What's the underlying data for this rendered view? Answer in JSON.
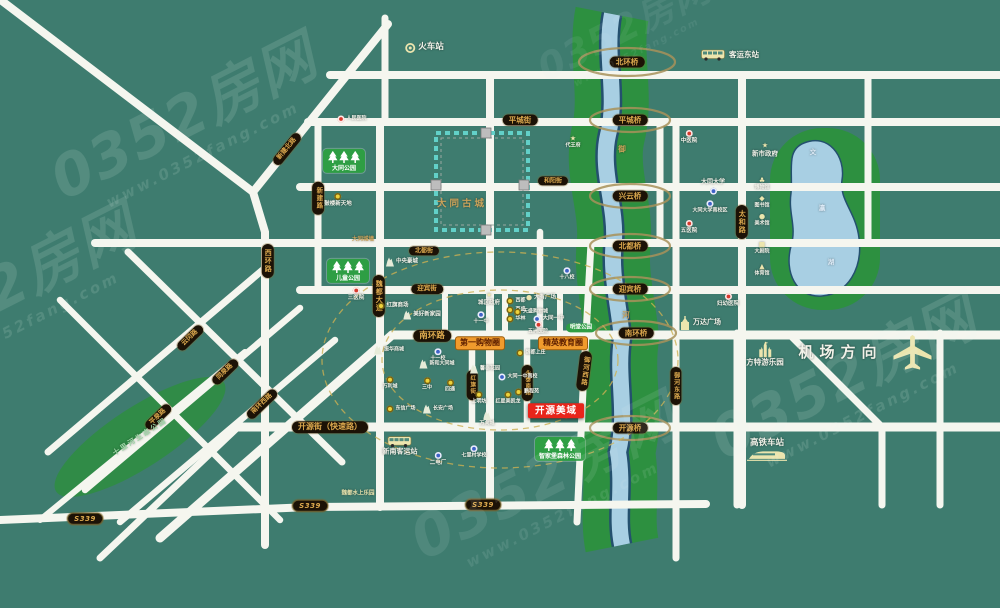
{
  "watermarks": {
    "brand": "0352房网",
    "site": "www.0352fang.com"
  },
  "map": {
    "labels": [
      {
        "n": "bridge-beihuanqiao",
        "t": "pill",
        "x": 627,
        "y": 62,
        "fs": 7.5,
        "text": "北环桥"
      },
      {
        "n": "bridge-pingchengqiao",
        "t": "pill",
        "x": 630,
        "y": 120,
        "fs": 7.5,
        "text": "平城桥"
      },
      {
        "n": "bridge-xingyunqiao",
        "t": "pill",
        "x": 630,
        "y": 196,
        "fs": 7.5,
        "text": "兴云桥"
      },
      {
        "n": "bridge-beiduqiao",
        "t": "pill",
        "x": 630,
        "y": 246,
        "fs": 7.5,
        "text": "北都桥"
      },
      {
        "n": "bridge-yingbinqiao",
        "t": "pill",
        "x": 630,
        "y": 289,
        "fs": 7.5,
        "text": "迎宾桥"
      },
      {
        "n": "bridge-nanhuanqiao",
        "t": "pill",
        "x": 636,
        "y": 333,
        "fs": 7.5,
        "text": "南环桥"
      },
      {
        "n": "bridge-kaiyuanqiao",
        "t": "pill",
        "x": 630,
        "y": 428,
        "fs": 7.5,
        "text": "开源桥"
      },
      {
        "n": "road-pingchengjie",
        "t": "pill",
        "x": 520,
        "y": 120,
        "fs": 7.5,
        "text": "平城街"
      },
      {
        "n": "road-heyangjie",
        "t": "pill",
        "x": 553,
        "y": 181,
        "fs": 6,
        "text": "和阳街"
      },
      {
        "n": "road-beidujie",
        "t": "pill",
        "x": 424,
        "y": 251,
        "fs": 6,
        "text": "北都街"
      },
      {
        "n": "road-yingbinjie",
        "t": "pill",
        "x": 427,
        "y": 289,
        "fs": 6.5,
        "text": "迎宾街"
      },
      {
        "n": "road-nanhuanlu",
        "t": "pill",
        "x": 432,
        "y": 336,
        "fs": 8.5,
        "text": "南环路"
      },
      {
        "n": "road-kaiyuanjie",
        "t": "pill",
        "x": 330,
        "y": 427,
        "fs": 8,
        "text": "开源街（快速路）"
      },
      {
        "n": "road-weidudadao",
        "t": "pill",
        "v": 1,
        "x": 379,
        "y": 296,
        "fs": 7,
        "text": "魏都大道"
      },
      {
        "n": "road-xinjianlu",
        "t": "pill",
        "v": 1,
        "x": 318,
        "y": 198,
        "fs": 6.5,
        "text": "新建路"
      },
      {
        "n": "road-xinjianbeilu",
        "t": "pill",
        "x": 287,
        "y": 149,
        "r": -51,
        "fs": 6.5,
        "text": "新建北路"
      },
      {
        "n": "road-xihuanlu",
        "t": "pill",
        "v": 1,
        "x": 268,
        "y": 261,
        "fs": 7,
        "text": "西环路"
      },
      {
        "n": "road-taihelu",
        "t": "pill",
        "v": 1,
        "x": 742,
        "y": 222,
        "fs": 7,
        "text": "太和路"
      },
      {
        "n": "road-yuhexilu",
        "t": "pill",
        "v": 1,
        "x": 584,
        "y": 371,
        "r": 7,
        "fs": 6.5,
        "text": "御河西路"
      },
      {
        "n": "road-yuhedonglu",
        "t": "pill",
        "v": 1,
        "x": 676,
        "y": 386,
        "fs": 6,
        "text": "御河东路"
      },
      {
        "n": "road-hongqijie",
        "t": "pill",
        "v": 1,
        "x": 472,
        "y": 385,
        "fs": 5.5,
        "text": "红旗街"
      },
      {
        "n": "road-yongtainanlu",
        "t": "pill",
        "v": 1,
        "x": 527,
        "y": 383,
        "fs": 5.5,
        "text": "永泰南路"
      },
      {
        "n": "road-yunganglu",
        "t": "pill",
        "x": 190,
        "y": 338,
        "r": -44,
        "fs": 6.5,
        "text": "云冈路"
      },
      {
        "n": "road-tongquanlu",
        "t": "pill",
        "x": 225,
        "y": 372,
        "r": -44,
        "fs": 6.5,
        "text": "同泉路"
      },
      {
        "n": "road-nanhuanxilu",
        "t": "pill",
        "x": 262,
        "y": 404,
        "r": -44,
        "fs": 6.5,
        "text": "南环西路"
      },
      {
        "n": "road-pingquanlu",
        "t": "pill",
        "x": 158,
        "y": 417,
        "r": -44,
        "fs": 6.5,
        "text": "平泉路"
      },
      {
        "n": "shield-s339-west",
        "t": "shield",
        "x": 85,
        "y": 519,
        "fs": 7,
        "text": "S339"
      },
      {
        "n": "shield-s339-mid",
        "t": "shield",
        "x": 310,
        "y": 506,
        "fs": 7,
        "text": "S339"
      },
      {
        "n": "shield-s339-east",
        "t": "shield",
        "x": 483,
        "y": 505,
        "fs": 7,
        "text": "S339"
      },
      {
        "n": "tag-shopping-circle",
        "t": "tag",
        "x": 480,
        "y": 343,
        "fs": 8,
        "text": "第一购物圈"
      },
      {
        "n": "tag-education-circle",
        "t": "tag",
        "x": 563,
        "y": 343,
        "fs": 8,
        "text": "精英教育圈"
      },
      {
        "n": "project-kaiyuanmeiyu",
        "t": "proj",
        "x": 556,
        "y": 411,
        "fs": 9.5,
        "text": "开源美域"
      },
      {
        "n": "park-datong",
        "t": "sign",
        "x": 344,
        "y": 161,
        "text": "大同公园"
      },
      {
        "n": "park-ertong",
        "t": "sign",
        "x": 348,
        "y": 271,
        "text": "儿童公园"
      },
      {
        "n": "park-zhijiabao",
        "t": "sign",
        "x": 560,
        "y": 449,
        "text": "智家堡森林公园"
      },
      {
        "n": "park-mingtang",
        "t": "ptag",
        "x": 581,
        "y": 328,
        "fs": 5.5,
        "text": "明堂公园"
      },
      {
        "n": "park-shilihe",
        "t": "txt",
        "x": 140,
        "y": 437,
        "c": "gl",
        "fs": 7,
        "r": -33,
        "ls": 2,
        "text": "十里河生态公园"
      },
      {
        "n": "ancient-city-label",
        "t": "txt",
        "x": 462,
        "y": 204,
        "c": "tan",
        "fs": 9.5,
        "ls": 3,
        "text": "大同古城"
      },
      {
        "n": "city-wall-label",
        "t": "txt",
        "x": 363,
        "y": 240,
        "c": "tan",
        "fs": 5.5,
        "text": "大同城墙"
      },
      {
        "n": "river-char-yu",
        "t": "txt",
        "x": 622,
        "y": 149,
        "c": "tan",
        "fs": 7.5,
        "text": "御"
      },
      {
        "n": "river-char-he",
        "t": "txt",
        "x": 626,
        "y": 315,
        "c": "tan",
        "fs": 7.5,
        "text": "河"
      },
      {
        "n": "lake-char-wen",
        "t": "txt",
        "x": 813,
        "y": 153,
        "c": "lake",
        "fs": 6.5,
        "text": "文"
      },
      {
        "n": "lake-char-ying",
        "t": "txt",
        "x": 822,
        "y": 209,
        "c": "lake",
        "fs": 6.5,
        "text": "瀛"
      },
      {
        "n": "lake-char-hu",
        "t": "txt",
        "x": 831,
        "y": 263,
        "c": "lake",
        "fs": 6.5,
        "text": "湖"
      },
      {
        "n": "train-station",
        "t": "poi",
        "ic": "svg:ring",
        "tp": "r",
        "x": 424,
        "y": 48,
        "c": "w",
        "fs": 8.5,
        "text": "火车站"
      },
      {
        "n": "east-bus-station",
        "t": "poi",
        "ic": "svg:bus",
        "tp": "r",
        "x": 730,
        "y": 55,
        "c": "w",
        "fs": 7.5,
        "text": "客运东站"
      },
      {
        "n": "south-bus-station",
        "t": "poi",
        "ic": "svg:bus",
        "tp": "b",
        "x": 400,
        "y": 446,
        "c": "cream",
        "fs": 7,
        "text": "新南客运站"
      },
      {
        "n": "airport-direction",
        "t": "poi",
        "ic": "svg:plane",
        "tp": "l",
        "x": 866,
        "y": 352,
        "c": "cream",
        "fs": 15,
        "ls": 6,
        "text": "机场方向"
      },
      {
        "n": "hsr-station",
        "t": "poi",
        "ic": "svg:hsr",
        "tp": "a",
        "x": 767,
        "y": 451,
        "c": "cream",
        "fs": 8.5,
        "text": "高铁车站"
      },
      {
        "n": "fantawild-park",
        "t": "poi",
        "ic": "svg:castle",
        "tp": "b",
        "x": 765,
        "y": 354,
        "c": "cream",
        "fs": 7.5,
        "text": "方特游乐园"
      },
      {
        "n": "wanda-plaza",
        "t": "poi",
        "ic": "svg:tower",
        "tp": "r",
        "x": 700,
        "y": 323,
        "c": "w",
        "fs": 7,
        "text": "万达广场"
      },
      {
        "n": "poi-renmin-hospital",
        "t": "poi",
        "ic": "red",
        "tp": "r",
        "x": 352,
        "y": 119,
        "fs": 5,
        "text": "人民医院"
      },
      {
        "n": "poi-gulou-xintiandi",
        "t": "poi",
        "ic": "yellow",
        "tp": "b",
        "x": 338,
        "y": 200,
        "fs": 5.5,
        "text": "鼓楼新天地"
      },
      {
        "n": "poi-sanyiyuan",
        "t": "poi",
        "ic": "red",
        "tp": "b",
        "x": 356,
        "y": 294,
        "fs": 5.5,
        "text": "三医院"
      },
      {
        "n": "poi-hongqi-mall",
        "t": "poi",
        "ic": "yellow",
        "tp": "r",
        "x": 393,
        "y": 306,
        "fs": 5.5,
        "text": "红旗商场"
      },
      {
        "n": "poi-meihao-xinjiayuan",
        "t": "poi",
        "ic": "bld",
        "tp": "r",
        "x": 422,
        "y": 315,
        "fs": 5.5,
        "text": "美好新家园"
      },
      {
        "n": "poi-zhongyang-haocheng",
        "t": "poi",
        "ic": "bld",
        "tp": "r",
        "x": 402,
        "y": 262,
        "fs": 5.5,
        "text": "中央豪城"
      },
      {
        "n": "poi-chengqu-gov",
        "t": "poi",
        "ic": "g:★",
        "gc": "w",
        "tp": "b",
        "x": 489,
        "y": 299,
        "fs": 5.5,
        "text": "城区政府"
      },
      {
        "n": "poi-xidu",
        "t": "poi",
        "ic": "yellow",
        "tp": "r",
        "x": 516,
        "y": 301,
        "fs": 5,
        "text": "西都"
      },
      {
        "n": "poi-baisheng",
        "t": "poi",
        "ic": "yellow",
        "tp": "r",
        "x": 516,
        "y": 310,
        "fs": 5,
        "text": "百盛"
      },
      {
        "n": "poi-hualin",
        "t": "poi",
        "ic": "yellow",
        "tp": "r",
        "x": 516,
        "y": 319,
        "fs": 5,
        "text": "华林"
      },
      {
        "n": "poi-shiyizhong",
        "t": "poi",
        "ic": "blue",
        "tp": "b",
        "x": 481,
        "y": 318,
        "fs": 5,
        "text": "十一中"
      },
      {
        "n": "poi-shiyixiao",
        "t": "poi",
        "ic": "blue",
        "tp": "b",
        "x": 438,
        "y": 355,
        "fs": 5,
        "text": "十一校"
      },
      {
        "n": "poi-shibaxiao",
        "t": "poi",
        "ic": "blue",
        "tp": "b",
        "x": 567,
        "y": 274,
        "fs": 5,
        "text": "十八校"
      },
      {
        "n": "poi-dayou-plaza",
        "t": "poi",
        "ic": "g:●",
        "gc": "cream",
        "tp": "r",
        "x": 541,
        "y": 298,
        "fs": 5.5,
        "text": "大有广场"
      },
      {
        "n": "poi-tiansheng-mall",
        "t": "poi",
        "ic": "yellow",
        "tp": "r",
        "x": 531,
        "y": 312,
        "fs": 5,
        "text": "天盛购物城"
      },
      {
        "n": "poi-datong-yizhong",
        "t": "poi",
        "ic": "blue",
        "tp": "r",
        "x": 549,
        "y": 319,
        "fs": 5.5,
        "text": "大同一中"
      },
      {
        "n": "poi-wuzhou-hospital",
        "t": "poi",
        "ic": "red",
        "tp": "b",
        "x": 538,
        "y": 328,
        "fs": 5,
        "text": "五洲医院"
      },
      {
        "n": "poi-weidu-shangzhuang",
        "t": "poi",
        "ic": "yellow",
        "tp": "r",
        "x": 531,
        "y": 353,
        "fs": 5,
        "text": "魏都上庄"
      },
      {
        "n": "poi-yizhong-south",
        "t": "poi",
        "ic": "blue",
        "tp": "r",
        "x": 518,
        "y": 377,
        "fs": 5,
        "text": "大同一中南校"
      },
      {
        "n": "poi-pengchengyuan",
        "t": "poi",
        "ic": "yellow",
        "tp": "r",
        "x": 527,
        "y": 392,
        "fs": 5,
        "text": "鹏程苑"
      },
      {
        "n": "poi-xintai-garden",
        "t": "poi",
        "ic": "bld",
        "tp": "r",
        "x": 485,
        "y": 369,
        "fs": 5,
        "text": "馨泰花园"
      },
      {
        "n": "poi-shangmingfang",
        "t": "poi",
        "ic": "yellow",
        "tp": "b",
        "x": 479,
        "y": 398,
        "fs": 5,
        "text": "上明坊"
      },
      {
        "n": "poi-hongxing",
        "t": "poi",
        "ic": "yellow",
        "tp": "b",
        "x": 508,
        "y": 398,
        "fs": 5,
        "text": "红星美凯龙"
      },
      {
        "n": "poi-wanxiangcheng",
        "t": "poi",
        "ic": "bld",
        "tp": "b",
        "x": 487,
        "y": 419,
        "fs": 5,
        "text": "万向城"
      },
      {
        "n": "poi-xinhe-datongcheng",
        "t": "poi",
        "ic": "bld",
        "tp": "r",
        "x": 437,
        "y": 364,
        "fs": 5,
        "text": "新和大同城"
      },
      {
        "n": "poi-wanlicheng",
        "t": "poi",
        "ic": "yellow",
        "tp": "b",
        "x": 390,
        "y": 383,
        "fs": 5,
        "text": "万利城"
      },
      {
        "n": "poi-sanzhong",
        "t": "poi",
        "ic": "yellow",
        "tp": "b",
        "x": 427,
        "y": 384,
        "fs": 5,
        "text": "三中"
      },
      {
        "n": "poi-sitong",
        "t": "poi",
        "ic": "yellow",
        "tp": "b",
        "x": 450,
        "y": 386,
        "fs": 5,
        "text": "四通"
      },
      {
        "n": "poi-dongxin-plaza",
        "t": "poi",
        "ic": "yellow",
        "tp": "r",
        "x": 401,
        "y": 409,
        "fs": 5,
        "text": "东信广场"
      },
      {
        "n": "poi-changan-plaza",
        "t": "poi",
        "ic": "bld",
        "tp": "r",
        "x": 438,
        "y": 409,
        "fs": 5,
        "text": "长安广场"
      },
      {
        "n": "poi-zhenhua-mall",
        "t": "poi",
        "ic": "bld",
        "tp": "r",
        "x": 389,
        "y": 350,
        "fs": 5,
        "text": "振华商城"
      },
      {
        "n": "poi-erdianchang",
        "t": "poi",
        "ic": "blue",
        "tp": "b",
        "x": 438,
        "y": 459,
        "fs": 5.5,
        "text": "二电厂"
      },
      {
        "n": "poi-qilicun-school",
        "t": "poi",
        "ic": "blue",
        "tp": "b",
        "x": 474,
        "y": 452,
        "fs": 5,
        "text": "七里村学校"
      },
      {
        "n": "poi-weidu-waterpark",
        "t": "txt",
        "x": 358,
        "y": 494,
        "c": "cream",
        "fs": 5.5,
        "text": "魏都水上乐园"
      },
      {
        "n": "poi-zhongyiyuan",
        "t": "poi",
        "ic": "red",
        "tp": "b",
        "x": 689,
        "y": 137,
        "fs": 5.5,
        "text": "中医院"
      },
      {
        "n": "poi-wuyiyuan",
        "t": "poi",
        "ic": "red",
        "tp": "b",
        "x": 689,
        "y": 227,
        "fs": 5.5,
        "text": "五医院"
      },
      {
        "n": "poi-fuyou-hospital",
        "t": "poi",
        "ic": "red",
        "tp": "b",
        "x": 728,
        "y": 300,
        "fs": 5.5,
        "text": "妇幼医院"
      },
      {
        "n": "poi-datong-university",
        "t": "poi",
        "ic": "blue",
        "tp": "a",
        "x": 713,
        "y": 187,
        "c": "w",
        "fs": 6,
        "text": "大同大学"
      },
      {
        "n": "poi-university-south",
        "t": "poi",
        "ic": "blue",
        "tp": "b",
        "x": 710,
        "y": 207,
        "fs": 5,
        "text": "大同大学南校区"
      },
      {
        "n": "poi-new-city-gov",
        "t": "poi",
        "ic": "g:★",
        "gc": "cream",
        "tp": "b",
        "x": 765,
        "y": 150,
        "c": "cream",
        "fs": 6.5,
        "text": "新市政府"
      },
      {
        "n": "poi-museum",
        "t": "poi",
        "ic": "g:♣",
        "gc": "cream",
        "tp": "b",
        "x": 762,
        "y": 184,
        "c": "cream",
        "fs": 5,
        "text": "博物馆"
      },
      {
        "n": "poi-library",
        "t": "poi",
        "ic": "g:◆",
        "gc": "cream",
        "tp": "b",
        "x": 762,
        "y": 202,
        "c": "cream",
        "fs": 5,
        "text": "图书馆"
      },
      {
        "n": "poi-art-gallery",
        "t": "poi",
        "ic": "g:●",
        "gc": "cream",
        "tp": "b",
        "x": 762,
        "y": 220,
        "c": "cream",
        "fs": 5,
        "text": "美术馆"
      },
      {
        "n": "poi-grand-theater",
        "t": "poi",
        "ic": "g:■",
        "gc": "cream",
        "tp": "b",
        "x": 762,
        "y": 248,
        "c": "cream",
        "fs": 5,
        "text": "大剧院"
      },
      {
        "n": "poi-stadium",
        "t": "poi",
        "ic": "g:▲",
        "gc": "cream",
        "tp": "b",
        "x": 762,
        "y": 270,
        "c": "cream",
        "fs": 5,
        "text": "体育馆"
      },
      {
        "n": "poi-daiwangfu",
        "t": "poi",
        "ic": "g:★",
        "gc": "w",
        "tp": "b",
        "x": 573,
        "y": 142,
        "c": "w",
        "fs": 5,
        "text": "代王府"
      }
    ]
  }
}
